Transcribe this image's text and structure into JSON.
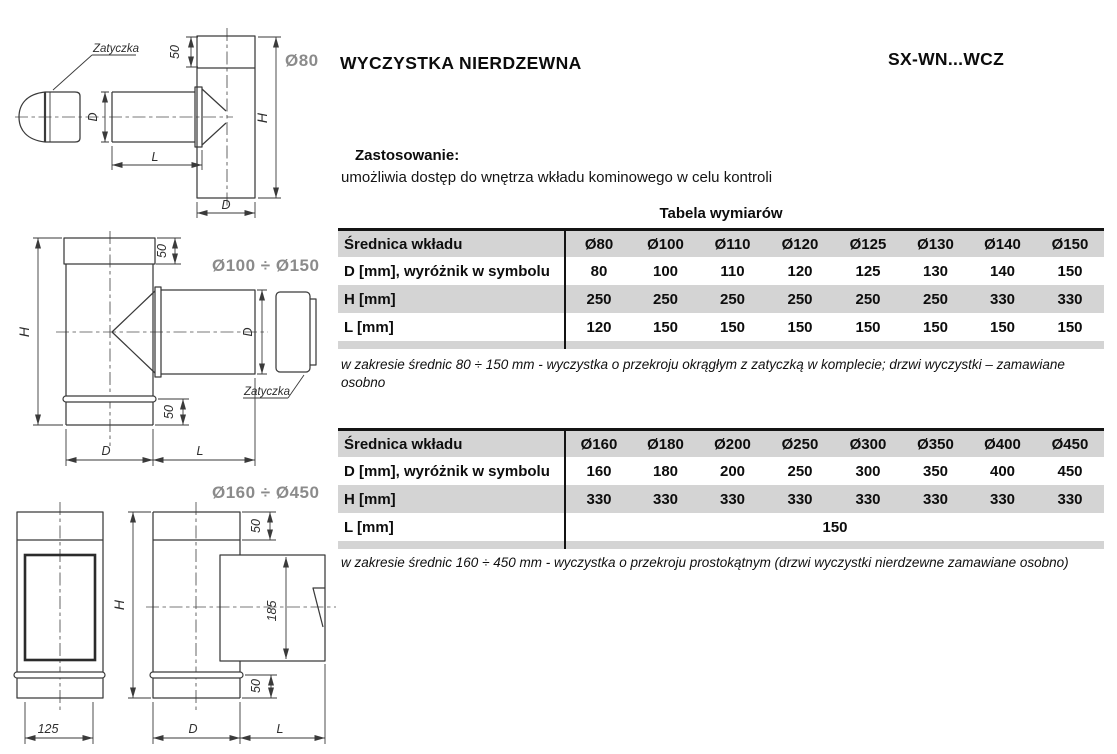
{
  "header": {
    "title": "WYCZYSTKA NIERDZEWNA",
    "product_code": "SX-WN...WCZ"
  },
  "application": {
    "heading": "Zastosowanie:",
    "description": "umożliwia dostęp do wnętrza wkładu kominowego w celu kontroli"
  },
  "dimension_tables": {
    "caption": "Tabela wymiarów",
    "table_small": {
      "header_label": "Średnica wkładu",
      "header_values": [
        "Ø80",
        "Ø100",
        "Ø110",
        "Ø120",
        "Ø125",
        "Ø130",
        "Ø140",
        "Ø150"
      ],
      "rows": [
        {
          "label": "D [mm],  wyróżnik w symbolu",
          "values": [
            "80",
            "100",
            "110",
            "120",
            "125",
            "130",
            "140",
            "150"
          ]
        },
        {
          "label": "H [mm]",
          "values": [
            "250",
            "250",
            "250",
            "250",
            "250",
            "250",
            "330",
            "330"
          ]
        },
        {
          "label": "L [mm]",
          "values": [
            "120",
            "150",
            "150",
            "150",
            "150",
            "150",
            "150",
            "150"
          ]
        }
      ],
      "note": "w zakresie średnic 80 ÷ 150 mm - wyczystka o przekroju okrągłym z zatyczką w komplecie; drzwi wyczystki – zamawiane osobno"
    },
    "table_large": {
      "header_label": "Średnica wkładu",
      "header_values": [
        "Ø160",
        "Ø180",
        "Ø200",
        "Ø250",
        "Ø300",
        "Ø350",
        "Ø400",
        "Ø450"
      ],
      "rows": [
        {
          "label": "D [mm],  wyróżnik w symbolu",
          "values": [
            "160",
            "180",
            "200",
            "250",
            "300",
            "350",
            "400",
            "450"
          ]
        },
        {
          "label": "H [mm]",
          "values": [
            "330",
            "330",
            "330",
            "330",
            "330",
            "330",
            "330",
            "330"
          ]
        }
      ],
      "merged_row": {
        "label": "L [mm]",
        "value": "150"
      },
      "note": "w zakresie średnic 160 ÷ 450 mm - wyczystka o przekroju prostokątnym (drzwi wyczystki nierdzewne zamawiane osobno)"
    }
  },
  "drawings": {
    "dim_labels": {
      "d": "D",
      "l": "L",
      "h": "H",
      "n50": "50",
      "n125": "125",
      "n185": "185"
    },
    "plug_label": "Zatyczka",
    "variant_small": "Ø80",
    "variant_medium": "Ø100 ÷ Ø150",
    "variant_large": "Ø160 ÷ Ø450"
  },
  "colors": {
    "table_row_gray": "#d4d4d4",
    "variant_label_gray": "#8b8b8b",
    "drawing_line": "#3a3a3a"
  }
}
